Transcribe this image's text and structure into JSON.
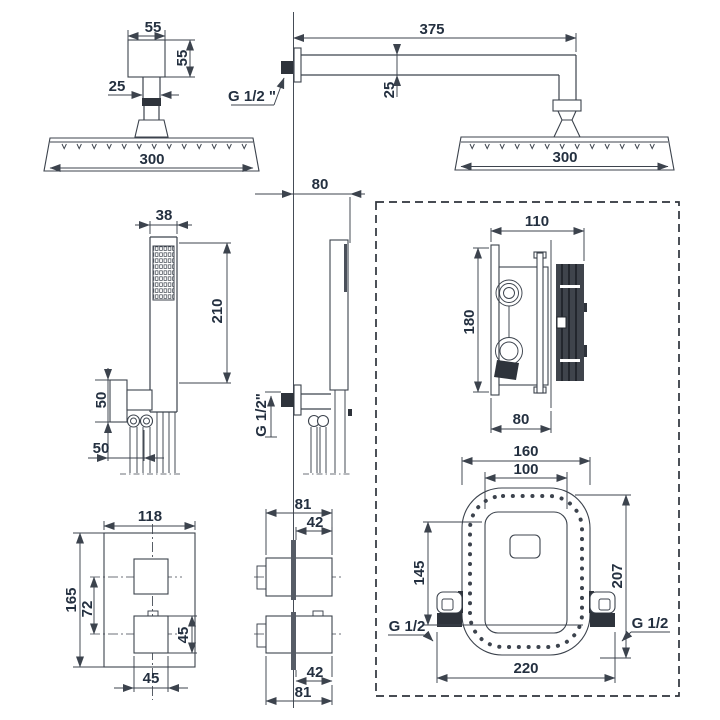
{
  "figures": {
    "rain_head_front": {
      "bracket_width": "55",
      "bracket_height": "55",
      "stem_width": "25",
      "head_width": "300"
    },
    "rain_head_side": {
      "arm_length": "375",
      "arm_height": "25",
      "head_width": "300",
      "thread_label": "G 1/2 \"",
      "wall_offset": "80"
    },
    "hand_shower_front": {
      "handle_width": "38",
      "handle_length": "210",
      "holder_height": "50",
      "holder_offset": "50"
    },
    "hand_shower_side": {
      "thread_label": "G 1/2\""
    },
    "mixer_side": {
      "width": "110",
      "height": "180",
      "built_in_depth": "80"
    },
    "mixer_front": {
      "plate_width": "160",
      "inner_width": "100",
      "inner_height": "145",
      "outer_height": "207",
      "box_width": "220",
      "thread_left": "G 1/2",
      "thread_right": "G 1/2"
    },
    "trim_front": {
      "plate_width": "118",
      "plate_height": "165",
      "knob_spacing": "72",
      "knob_height": "45",
      "knob_width": "45"
    },
    "trim_side": {
      "total_depth_top": "81",
      "knob_depth_top": "42",
      "knob_depth_bottom": "42",
      "total_depth_bottom": "81"
    }
  }
}
